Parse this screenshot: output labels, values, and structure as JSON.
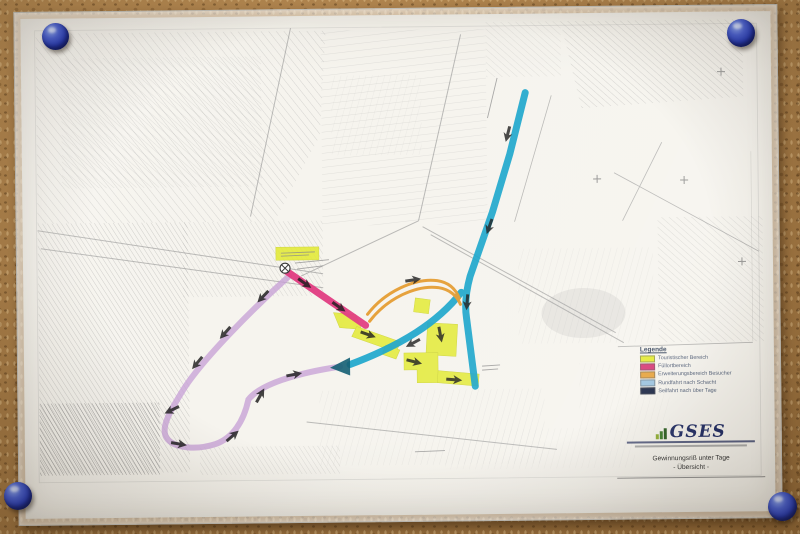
{
  "board": {
    "pin_color": "#2c3fbd",
    "pin_count": "4"
  },
  "map_sheet": {
    "legend": {
      "title": "Legende",
      "items": [
        {
          "label": "Touristischer Bereich",
          "color": "#e3ea35"
        },
        {
          "label": "Füllortbereich",
          "color": "#d63a76"
        },
        {
          "label": "Erweiterungsbereich Besucher",
          "color": "#e6a33e"
        },
        {
          "label": "Rundfahrt nach Schacht",
          "color": "#9cc3de"
        },
        {
          "label": "Seilfahrt nach über Tage",
          "color": "#1c2745"
        }
      ]
    },
    "title_block": {
      "company": "GSES",
      "caption_line1": "Gewinnungsriß unter Tage",
      "caption_line2": "- Übersicht -"
    },
    "route_colors": {
      "tourist_yellow": "#e3ea35",
      "pink": "#e03a80",
      "orange": "#e59b2e",
      "cyan": "#17a4cb",
      "purple_loop": "#c7a0d6"
    }
  }
}
